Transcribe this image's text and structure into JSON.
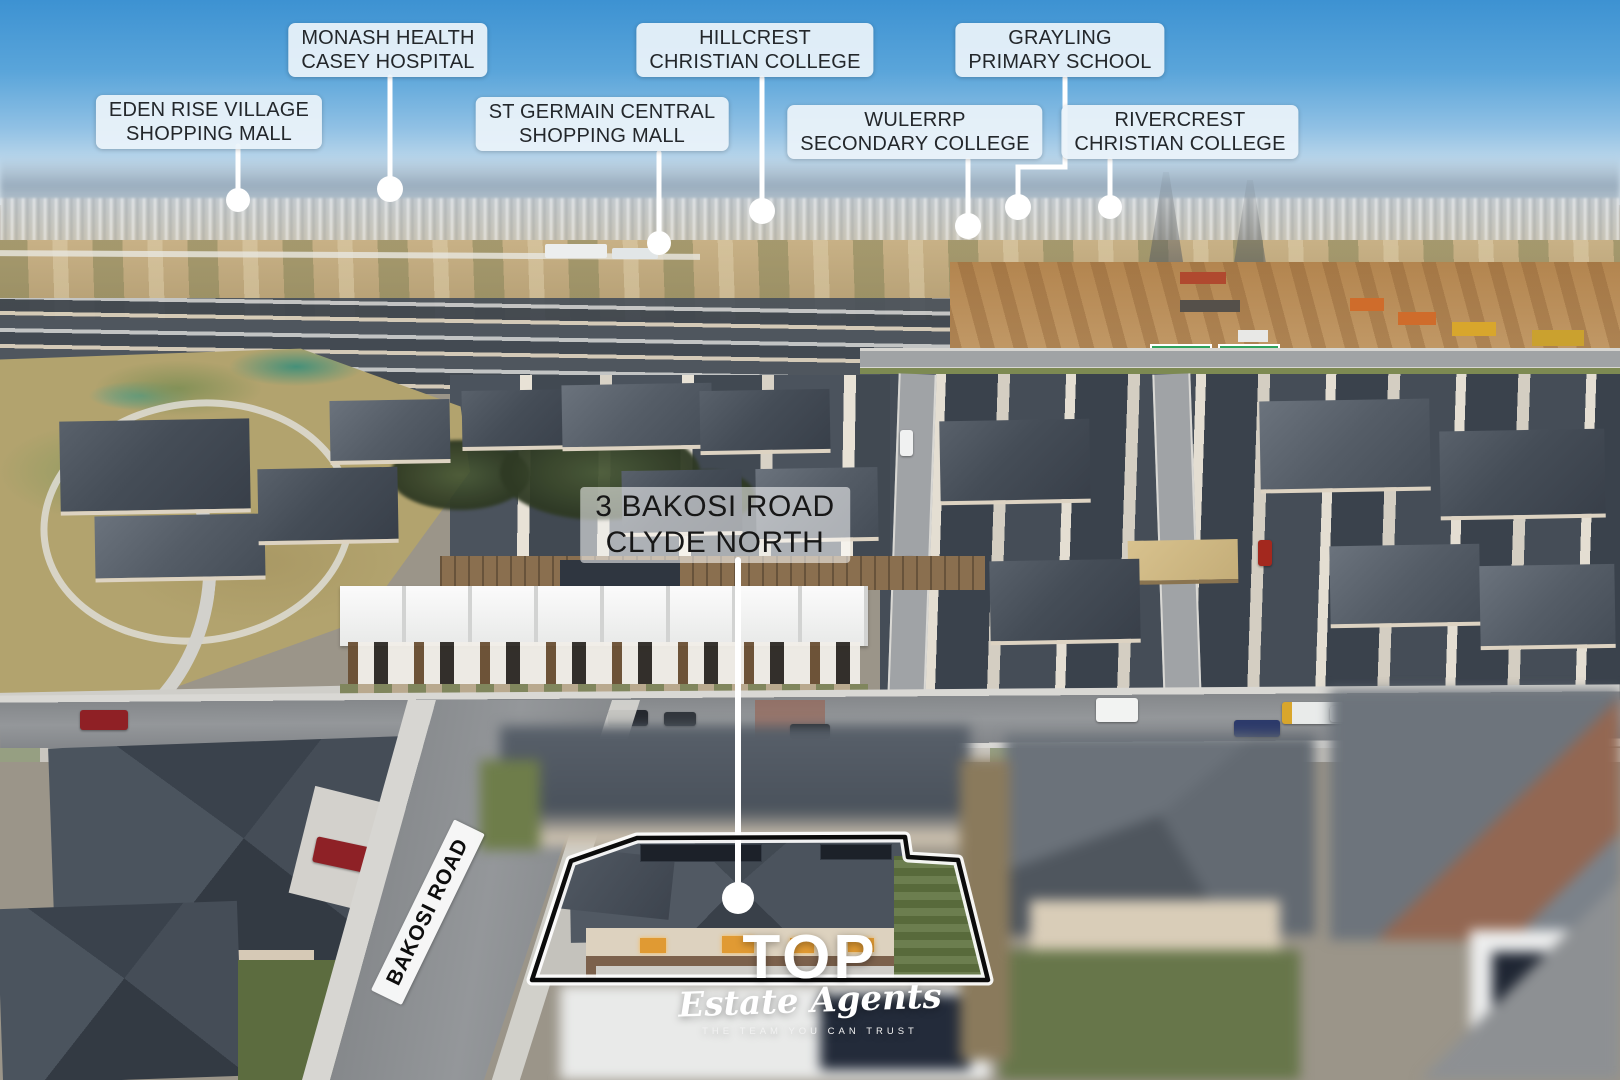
{
  "callouts": [
    {
      "id": "monash-health-casey-hospital",
      "line1": "MONASH HEALTH",
      "line2": "CASEY HOSPITAL"
    },
    {
      "id": "eden-rise-village-shopping-mall",
      "line1": "EDEN RISE VILLAGE",
      "line2": "SHOPPING MALL"
    },
    {
      "id": "hillcrest-christian-college",
      "line1": "HILLCREST",
      "line2": "CHRISTIAN COLLEGE"
    },
    {
      "id": "st-germain-central-shopping-mall",
      "line1": "ST GERMAIN CENTRAL",
      "line2": "SHOPPING MALL"
    },
    {
      "id": "grayling-primary-school",
      "line1": "GRAYLING",
      "line2": "PRIMARY SCHOOL"
    },
    {
      "id": "wulerrp-secondary-college",
      "line1": "WULERRP",
      "line2": "SECONDARY COLLEGE"
    },
    {
      "id": "rivercrest-christian-college",
      "line1": "RIVERCREST",
      "line2": "CHRISTIAN COLLEGE"
    }
  ],
  "property_label": {
    "line1": "3 BAKOSI ROAD",
    "line2": "CLYDE NORTH"
  },
  "road_label": "BAKOSI ROAD",
  "watermark": {
    "brand": "TOP",
    "sub": "Estate Agents",
    "tagline": "THE TEAM YOU CAN TRUST"
  },
  "colors": {
    "callout_background": "#ebf3fa",
    "callout_text": "#23272b",
    "leader_line": "#ffffff",
    "marker_dot": "#ffffff",
    "property_boundary": "#0b0b0b",
    "property_boundary_glow": "#ffffff",
    "watermark_text": "#ffffff"
  }
}
